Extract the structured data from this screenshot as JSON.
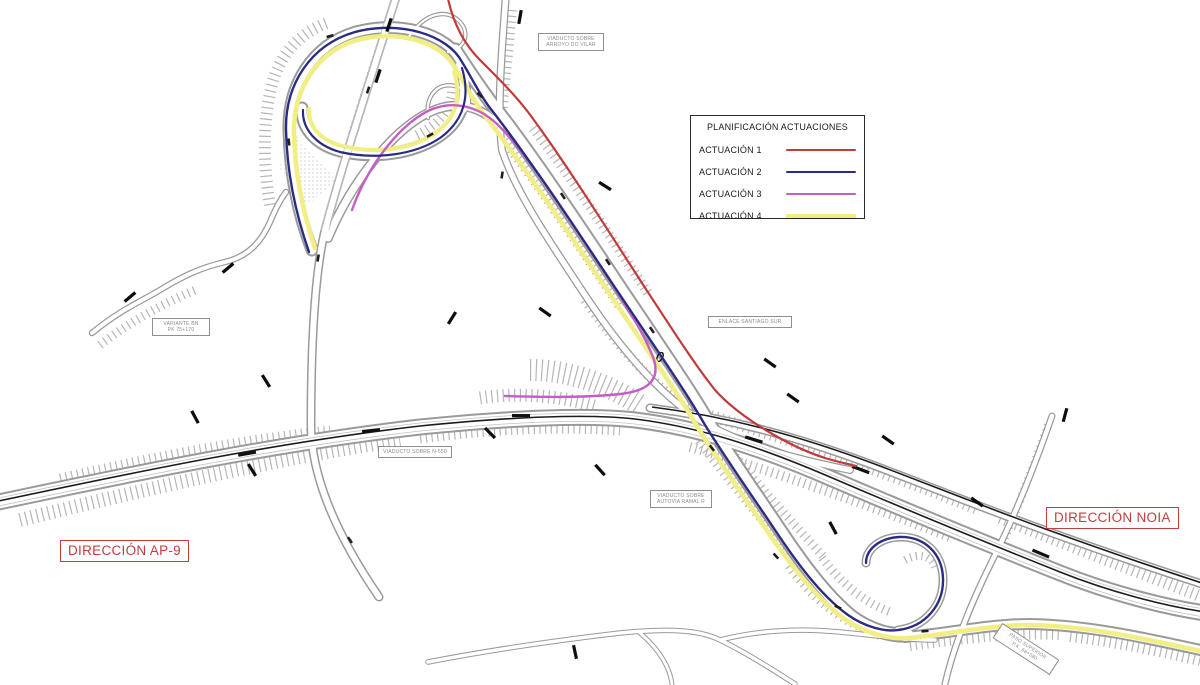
{
  "legend": {
    "title": "PLANIFICACIÓN ACTUACIONES",
    "items": [
      {
        "label": "ACTUACIÓN 1",
        "color": "#c23a3a"
      },
      {
        "label": "ACTUACIÓN 2",
        "color": "#2b2b84"
      },
      {
        "label": "ACTUACIÓN 3",
        "color": "#c45ec4"
      },
      {
        "label": "ACTUACIÓN 4",
        "color": "#f2ee86"
      }
    ]
  },
  "direction_labels": {
    "ap9": "DIRECCIÓN AP-9",
    "noia": "DIRECCIÓN NOIA"
  },
  "annotations": {
    "arroyo": {
      "lines": [
        "VIADUCTO SOBRE",
        "ARROYO DO VILAR"
      ]
    },
    "variante": {
      "lines": [
        "VARIANTE BN",
        "PK 75+170"
      ]
    },
    "enlace": {
      "lines": [
        "ENLACE SANTIAGO SUR"
      ]
    },
    "n550": {
      "lines": [
        "VIADUCTO SOBRE N-550"
      ]
    },
    "ramal": {
      "lines": [
        "VIADUCTO SOBRE",
        "AUTOVÍA RAMAL R"
      ]
    },
    "paso": {
      "lines": [
        "PASO SUPERIOR",
        "P.K. 68+580"
      ]
    }
  }
}
